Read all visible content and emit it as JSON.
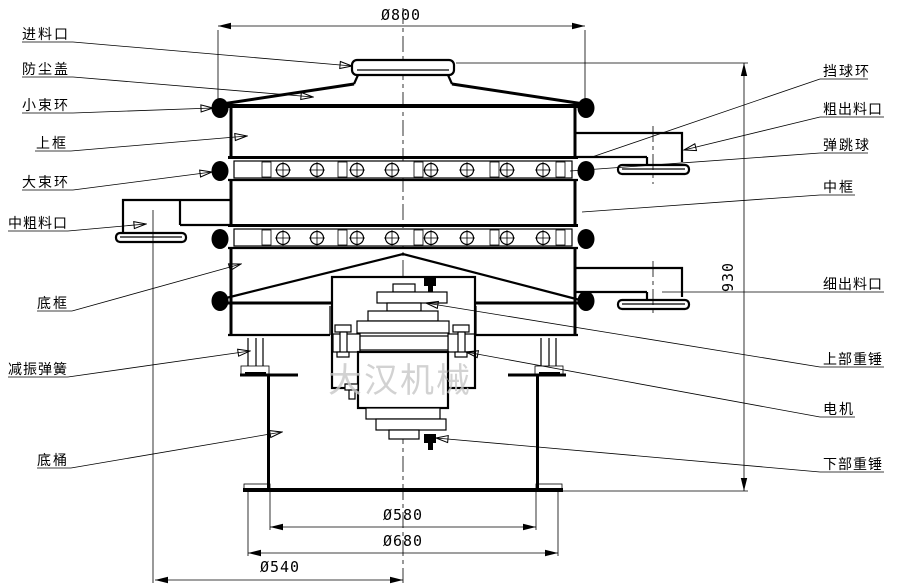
{
  "diagram": {
    "watermark": "大汉机械",
    "labels_left": [
      "进料口",
      "防尘盖",
      "小束环",
      "上框",
      "大束环",
      "中粗料口",
      "底框",
      "减振弹簧",
      "底桶"
    ],
    "labels_right": [
      "挡球环",
      "粗出料口",
      "弹跳球",
      "中框",
      "细出料口",
      "上部重锤",
      "电机",
      "下部重锤"
    ],
    "dimensions": {
      "top_diameter": "Ø800",
      "overall_height": "930",
      "barrel_diameter": "Ø580",
      "base_flange_diameter": "Ø680",
      "outlet_center_diameter": "Ø540"
    },
    "colors": {
      "line": "#000000",
      "watermark": "#c8c8c8",
      "background": "#ffffff"
    }
  }
}
